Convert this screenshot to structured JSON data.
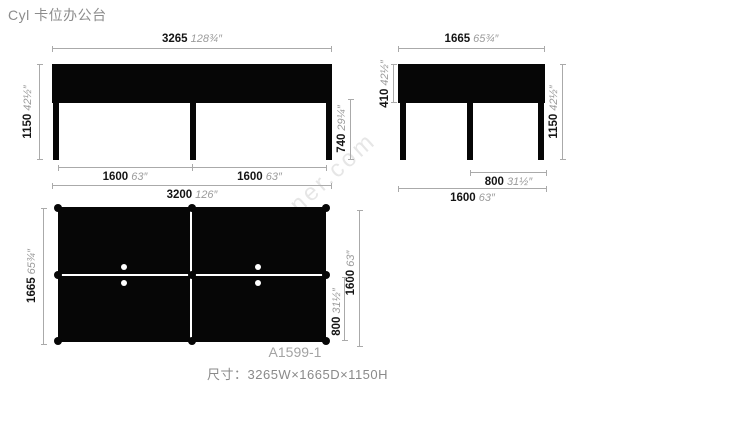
{
  "title": "Cyl 卡位办公台",
  "watermark": "snsuner.com",
  "model_code": "A1599-1",
  "size_caption": "尺寸：3265W×1665D×1150H",
  "colors": {
    "drawing": "#060606",
    "dimension_line": "#aaaaaa",
    "mm_text": "#151515",
    "inch_text": "#9b9b9b",
    "caption_text": "#8a8a8a"
  },
  "views": {
    "front": {
      "top": {
        "mm": "3265",
        "in": "128¾″"
      },
      "left": {
        "mm": "1150",
        "in": "42½″"
      },
      "right": {
        "mm": "740",
        "in": "29¼″"
      },
      "bottom_left": {
        "mm": "1600",
        "in": "63″"
      },
      "bottom_right": {
        "mm": "1600",
        "in": "63″"
      },
      "bottom_total": {
        "mm": "3200",
        "in": "126″"
      }
    },
    "side": {
      "top": {
        "mm": "1665",
        "in": "65¾″"
      },
      "left": {
        "mm": "410",
        "in": "42½″"
      },
      "right": {
        "mm": "1150",
        "in": "42½″"
      },
      "bottom_half": {
        "mm": "800",
        "in": "31½″"
      },
      "bottom_total": {
        "mm": "1600",
        "in": "63″"
      }
    },
    "plan": {
      "left": {
        "mm": "1665",
        "in": "65¾″"
      },
      "right_outer": {
        "mm": "1600",
        "in": "63″"
      },
      "right_inner": {
        "mm": "800",
        "in": "31½″"
      }
    }
  }
}
